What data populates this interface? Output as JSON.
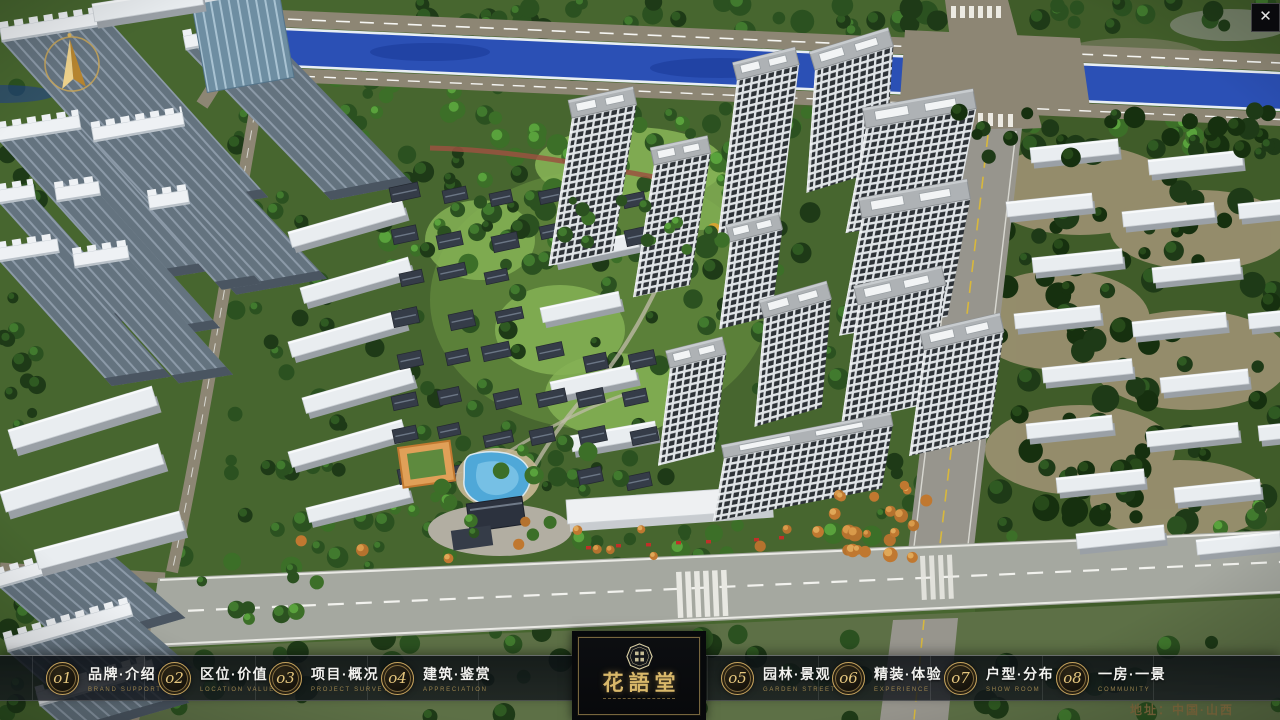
{
  "window": {
    "close_button": "✕"
  },
  "project": {
    "name": "花語堂",
    "address_line": "地址：中国·山西"
  },
  "navbar": {
    "items": [
      {
        "num": "o1",
        "title": "品牌·介绍",
        "subtitle": "BRAND SUPPORT"
      },
      {
        "num": "o2",
        "title": "区位·价值",
        "subtitle": "LOCATION VALUE"
      },
      {
        "num": "o3",
        "title": "项目·概况",
        "subtitle": "PROJECT SURVEY"
      },
      {
        "num": "o4",
        "title": "建筑·鉴赏",
        "subtitle": "APPRECIATION"
      },
      {
        "num": "o5",
        "title": "园林·景观",
        "subtitle": "GARDEN STREET"
      },
      {
        "num": "o6",
        "title": "精装·体验",
        "subtitle": "EXPERIENCE"
      },
      {
        "num": "o7",
        "title": "户型·分布",
        "subtitle": "SHOW ROOM"
      },
      {
        "num": "o8",
        "title": "一房·一景",
        "subtitle": "COMMUNITY"
      }
    ]
  },
  "colors": {
    "gold_accent": "#c8a55e",
    "nav_bg": "#0c1016",
    "river_blue": "#2b50b5",
    "pool_blue": "#4fa8d8",
    "road_tan": "#8d8674",
    "road_gray": "#a5a8a0",
    "tree_green": "#2f5a22",
    "tower_window": "#2d3237",
    "red_accent": "#c03028"
  }
}
